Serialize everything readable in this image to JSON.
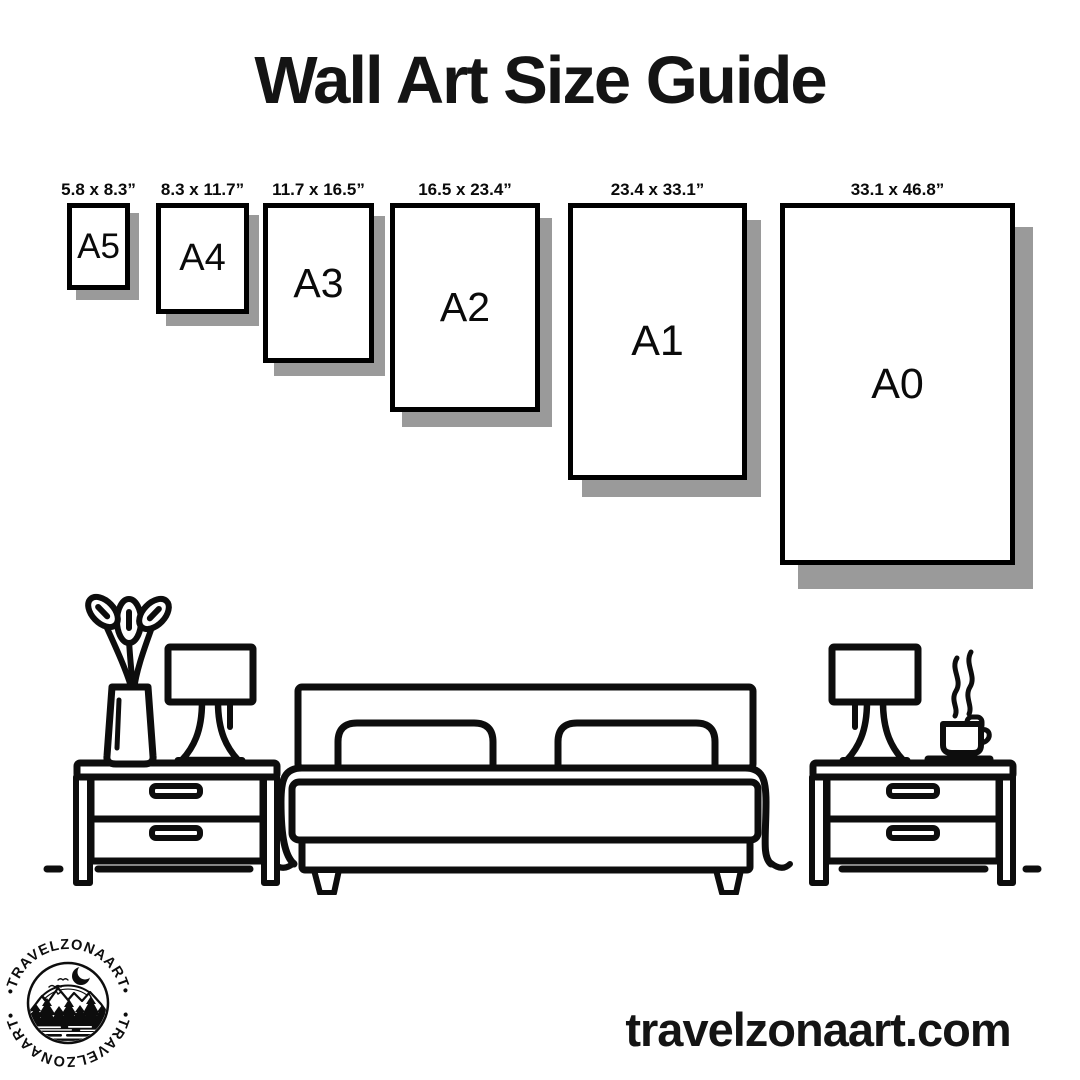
{
  "header": {
    "title": "Wall Art Size Guide"
  },
  "sizes": [
    {
      "code": "A5",
      "inches": "5.8 x 8.3”"
    },
    {
      "code": "A4",
      "inches": "8.3 x 11.7”"
    },
    {
      "code": "A3",
      "inches": "11.7 x 16.5”"
    },
    {
      "code": "A2",
      "inches": "16.5 x 23.4”"
    },
    {
      "code": "A1",
      "inches": "23.4 x 33.1”"
    },
    {
      "code": "A0",
      "inches": "33.1 x 46.8”"
    }
  ],
  "footer": {
    "website": "travelzonaart.com"
  },
  "logo": {
    "brand": "TRAVELZONAART",
    "arc_text_top": "•TRAVELZONAART•",
    "arc_text_bottom": "•TRAVELZONAART•"
  },
  "colors": {
    "ink": "#0d0d0d",
    "frame_border": "#000000",
    "frame_shadow": "#9a9a9a",
    "background": "#ffffff"
  },
  "icons": [
    "plant-vase-icon",
    "table-lamp-icon",
    "double-bed-icon",
    "nightstand-icon",
    "coffee-cup-icon",
    "mountain-badge-logo"
  ]
}
